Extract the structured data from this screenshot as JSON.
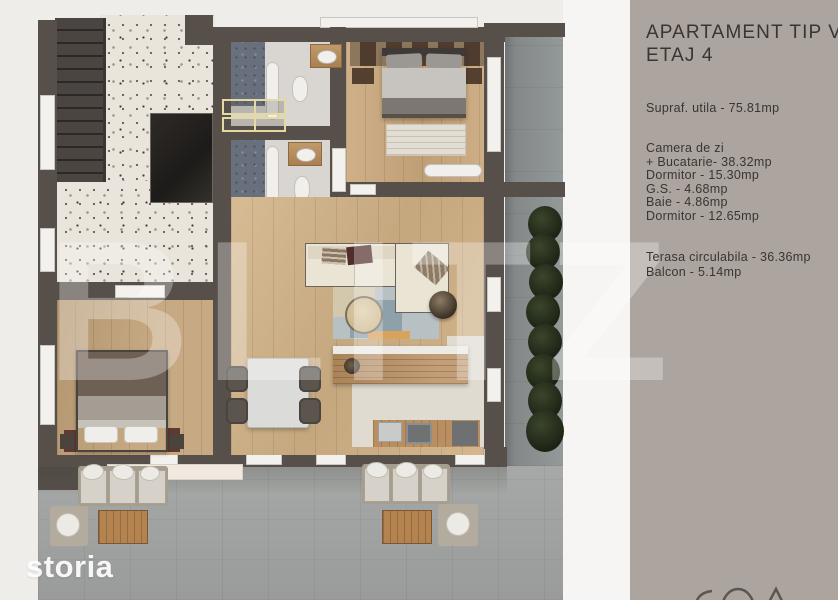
{
  "sidebar": {
    "title_line1": "APARTAMENT TIP V",
    "title_line2": "ETAJ 4",
    "total_area": "Supraf. utila - 75.81mp",
    "room_lines": [
      "Camera de zi",
      "+ Bucatarie- 38.32mp",
      "Dormitor - 15.30mp",
      "G.S. - 4.68mp",
      "Baie - 4.86mp",
      "Dormitor - 12.65mp"
    ],
    "outdoor_lines": [
      "Terasa circulabila - 36.36mp",
      "Balcon - 5.14mp"
    ]
  },
  "watermarks": {
    "portal": "storia",
    "agency": "BLITZ"
  },
  "palette": {
    "sidebar_bg": "#aca49e",
    "sidebar_text": "#3a3531",
    "wall": "#57504a",
    "window": "#f3f1ed",
    "terrazzo": "#e9e4dc",
    "stairs": "#4a4540",
    "elevator_shaft": "#23201e",
    "wood_bedroom1": "#c9a77c",
    "wood_living": "#d1b286",
    "wood_bedroom2": "#c2a379",
    "bath_floor": "#d9d6d2",
    "shower_tile": "#67707c",
    "vanity_wood": "#b78f60",
    "closet_accent": "#e6d9a0",
    "terrace": "#a1a4a2",
    "balcony": "#8e9394",
    "hedge": "#2b331f",
    "sofa_cream": "#eae4d4",
    "pillow_maroon": "#512d2b",
    "rug_blue": "#9fb0ba"
  }
}
